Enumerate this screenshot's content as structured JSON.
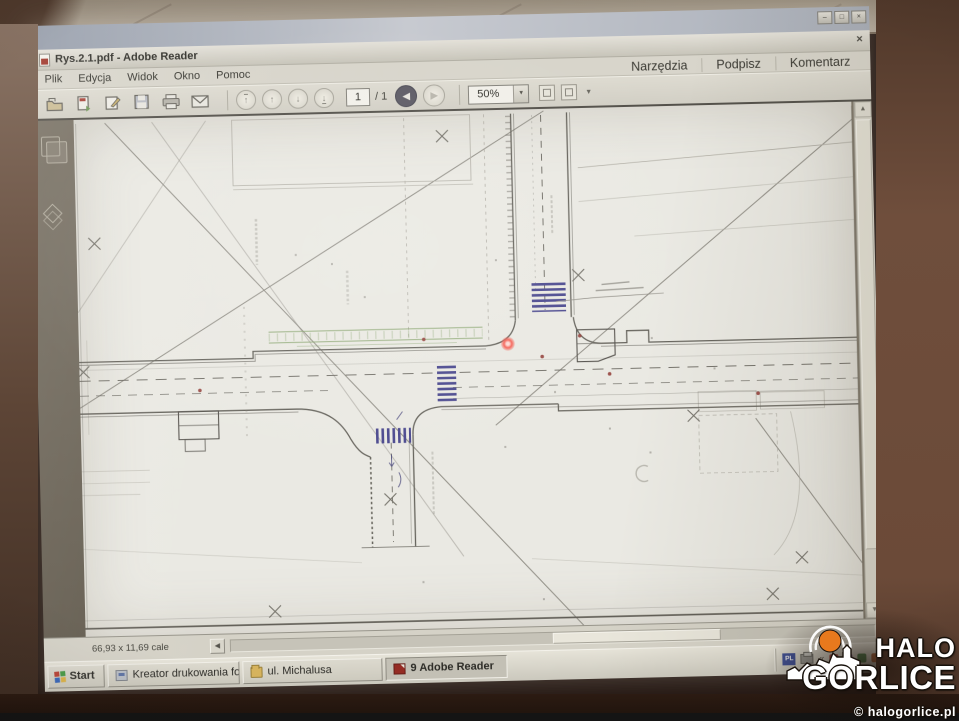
{
  "desktop": {
    "controls": {
      "minimize": "–",
      "maximize": "□",
      "close": "×"
    }
  },
  "reader": {
    "title": "Rys.2.1.pdf - Adobe Reader",
    "close_glyph": "×",
    "menu": [
      "Plik",
      "Edycja",
      "Widok",
      "Okno",
      "Pomoc"
    ],
    "tabs": [
      "Narzędzia",
      "Podpisz",
      "Komentarz"
    ],
    "toolbar": {
      "page_value": "1",
      "page_total": "/ 1",
      "zoom_value": "50%"
    },
    "status": {
      "page_size": "66,93 x 11,69 cale"
    }
  },
  "taskbar": {
    "start": "Start",
    "tasks": [
      "Kreator drukowania foto...",
      "ul. Michalusa",
      "9 Adobe Reader"
    ],
    "tray": {
      "language": "PL"
    }
  },
  "watermark": {
    "line1": "HALO",
    "line2": "GORLICE",
    "credit": "© halogorlice.pl"
  },
  "icons": {
    "up": "↑",
    "down": "↓",
    "back": "◀",
    "forward": "▶",
    "dropdown": "▼",
    "scroll_up": "▲",
    "scroll_down": "▼",
    "scroll_left": "◀",
    "collapse": "«"
  },
  "colors": {
    "laser_pointer": "#ff5f52",
    "crosswalk_blue": "#3f3d8f",
    "sidewalk_green": "#7d9e5e",
    "logo_orange": "#e8791d",
    "adobe_red": "#9c2a21"
  }
}
